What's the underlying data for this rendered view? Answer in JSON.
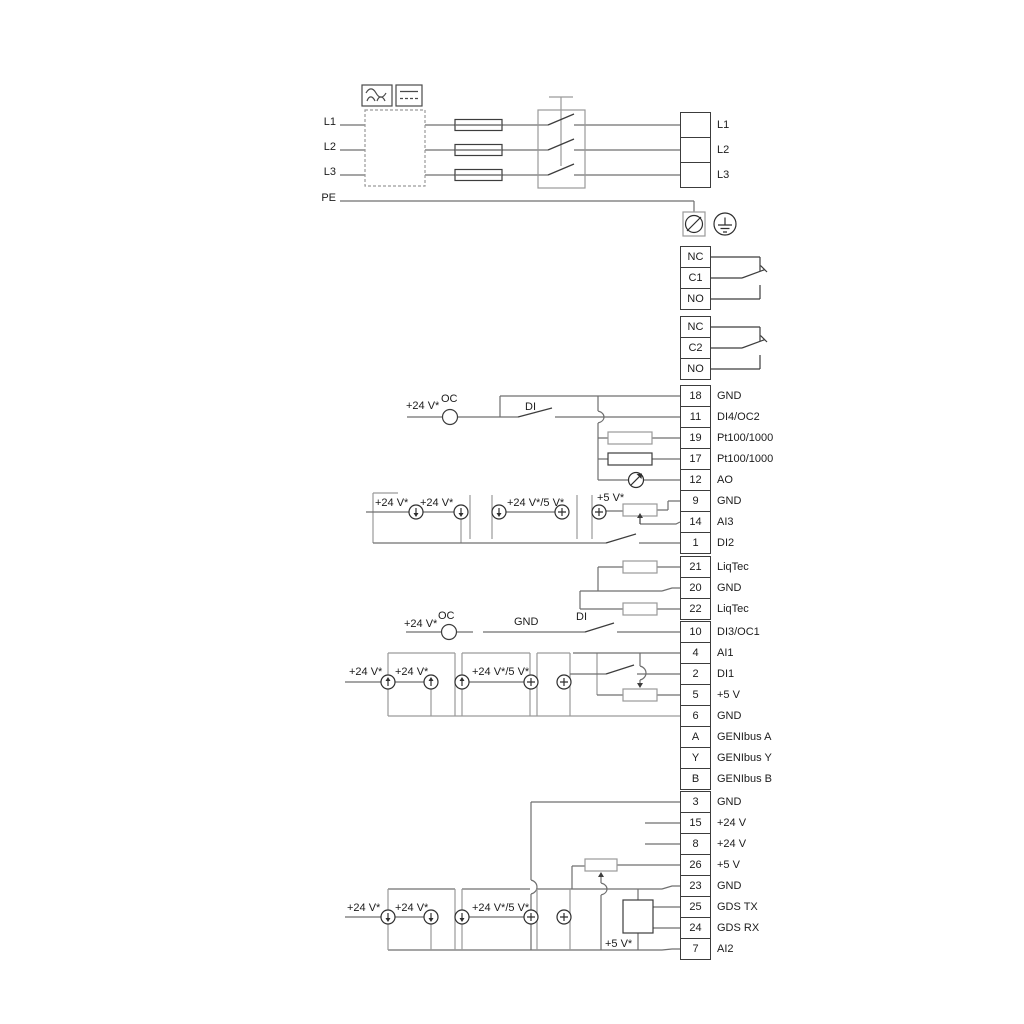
{
  "mains": {
    "in": [
      "L1",
      "L2",
      "L3",
      "PE"
    ],
    "out": [
      "L1",
      "L2",
      "L3"
    ]
  },
  "relays": {
    "r1": [
      "NC",
      "C1",
      "NO"
    ],
    "r2": [
      "NC",
      "C2",
      "NO"
    ]
  },
  "io1": [
    [
      "18",
      "GND"
    ],
    [
      "11",
      "DI4/OC2"
    ],
    [
      "19",
      "Pt100/1000"
    ],
    [
      "17",
      "Pt100/1000"
    ],
    [
      "12",
      "AO"
    ],
    [
      "9",
      "GND"
    ],
    [
      "14",
      "AI3"
    ],
    [
      "1",
      "DI2"
    ]
  ],
  "liqtec": [
    [
      "21",
      "LiqTec"
    ],
    [
      "20",
      "GND"
    ],
    [
      "22",
      "LiqTec"
    ]
  ],
  "io2": [
    [
      "10",
      "DI3/OC1"
    ],
    [
      "4",
      "AI1"
    ],
    [
      "2",
      "DI1"
    ],
    [
      "5",
      "+5 V"
    ],
    [
      "6",
      "GND"
    ],
    [
      "A",
      "GENIbus A"
    ],
    [
      "Y",
      "GENIbus Y"
    ],
    [
      "B",
      "GENIbus B"
    ]
  ],
  "io3": [
    [
      "3",
      "GND"
    ],
    [
      "15",
      "+24 V"
    ],
    [
      "8",
      "+24 V"
    ],
    [
      "26",
      "+5 V"
    ],
    [
      "23",
      "GND"
    ],
    [
      "25",
      "GDS TX"
    ],
    [
      "24",
      "GDS RX"
    ],
    [
      "7",
      "AI2"
    ]
  ],
  "ann": {
    "v24": "+24 V*",
    "v24_5": "+24 V*/5 V*",
    "v5": "+5 V*",
    "oc": "OC",
    "di": "DI",
    "gnd": "GND"
  }
}
